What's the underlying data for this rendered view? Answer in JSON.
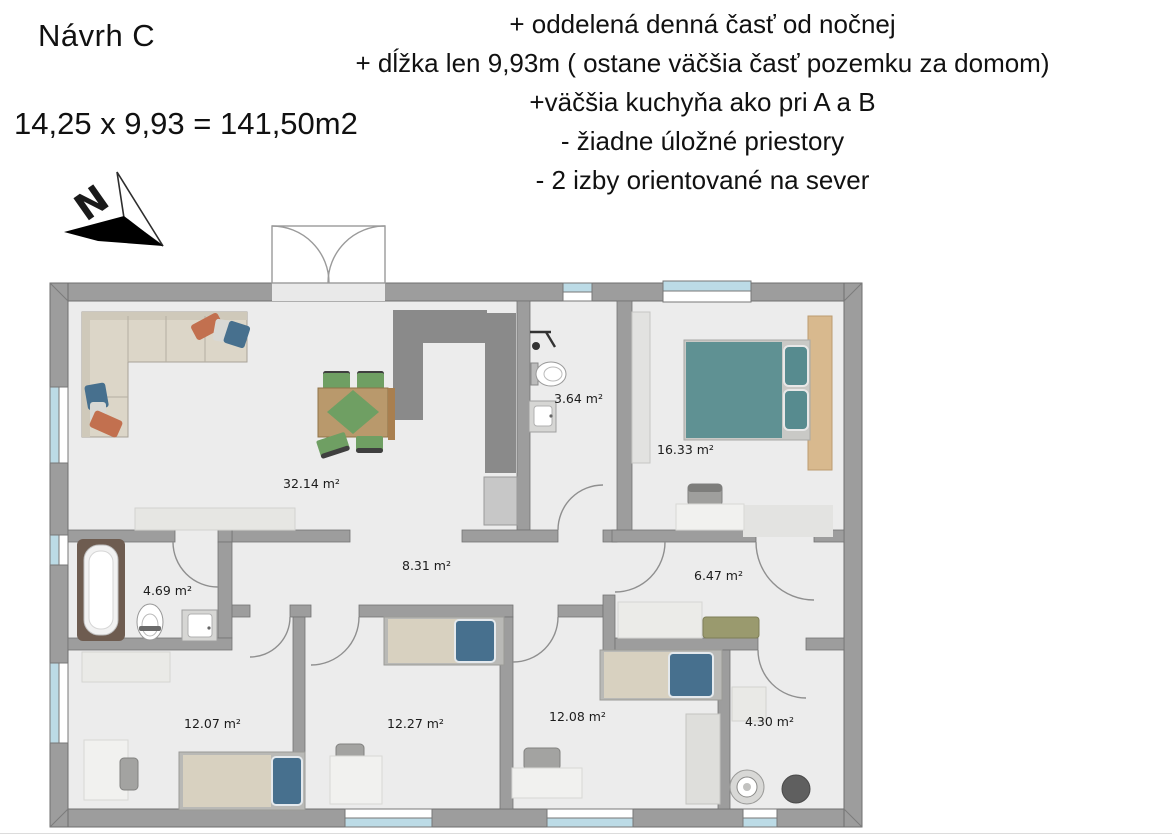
{
  "header": {
    "title": "Návrh C",
    "formula": "14,25 x 9,93 = 141,50m2",
    "notes": [
      "+ oddelená denná časť od nočnej",
      "+ dĺžka len 9,93m ( ostane väčšia časť pozemku za domom)",
      "+väčšia kuchyňa ako pri A a B",
      "- žiadne úložné priestory",
      "- 2 izby orientované na sever"
    ]
  },
  "compass": {
    "label": "N"
  },
  "rooms": [
    {
      "name": "living-dining-kitchen",
      "area": "32.14 m²"
    },
    {
      "name": "bathroom-small",
      "area": "3.64 m²"
    },
    {
      "name": "bedroom-master",
      "area": "16.33 m²"
    },
    {
      "name": "corridor",
      "area": "8.31 m²"
    },
    {
      "name": "bathroom-main",
      "area": "4.69 m²"
    },
    {
      "name": "hall",
      "area": "6.47 m²"
    },
    {
      "name": "bedroom-1",
      "area": "12.07 m²"
    },
    {
      "name": "bedroom-2",
      "area": "12.27 m²"
    },
    {
      "name": "bedroom-3",
      "area": "12.08 m²"
    },
    {
      "name": "utility-room",
      "area": "4.30 m²"
    }
  ],
  "palette": {
    "wall": "#9d9d9d",
    "floor": "#ececec",
    "window_glass": "#bcdbe6",
    "kitchen_counter": "#8a8a8a",
    "bed_teal": "#5f9193",
    "mattress_beige": "#d8d1c0",
    "pillow_blue": "#47708e",
    "pillow_orange": "#c2704f",
    "table_wood": "#b9996c",
    "chair_green": "#6f9f63",
    "bench_olive": "#9a9a6e",
    "tub_frame": "#6e5c50"
  }
}
